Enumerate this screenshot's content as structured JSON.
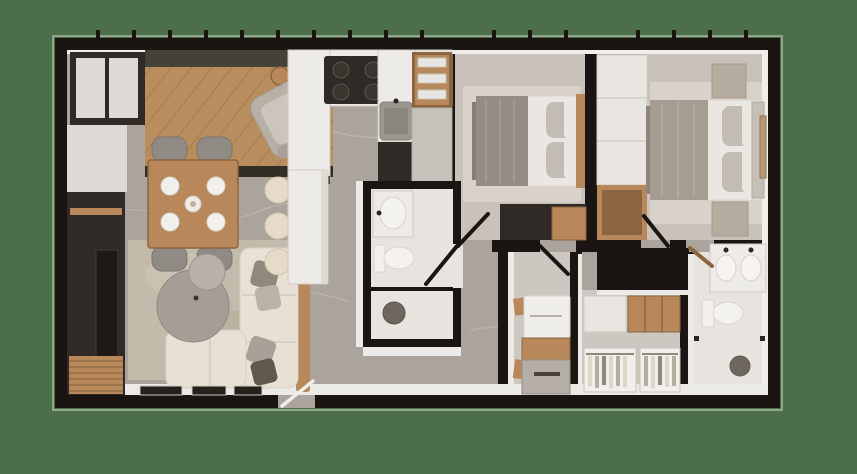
{
  "scene": {
    "type": "3d-floor-plan-render",
    "view": "top-down",
    "unit": "two-bedroom two-bathroom apartment",
    "rooms": [
      {
        "name": "entry-foyer",
        "furniture": [
          "wardrobe",
          "diagonal-wood-floor",
          "armchair",
          "ottoman",
          "side-table"
        ]
      },
      {
        "name": "dining-area",
        "furniture": [
          "wall-shelving",
          "dining-table",
          "chair",
          "chair",
          "chair",
          "chair",
          "plates",
          "centerpiece"
        ]
      },
      {
        "name": "living-room",
        "furniture": [
          "media-wall",
          "tv",
          "slat-bench",
          "rug",
          "l-sofa",
          "pillows",
          "round-ottoman",
          "picture-ledge"
        ]
      },
      {
        "name": "kitchen",
        "furniture": [
          "counter",
          "cooktop",
          "sink",
          "dish-shelf",
          "tall-cabinet",
          "island",
          "bar-stools"
        ]
      },
      {
        "name": "bathroom-main",
        "furniture": [
          "vanity-sink",
          "toilet",
          "shower",
          "floor-drain",
          "glass-screen"
        ]
      },
      {
        "name": "bedroom-secondary",
        "furniture": [
          "double-bed",
          "pillows",
          "headboard",
          "rug",
          "dresser"
        ]
      },
      {
        "name": "bedroom-master",
        "furniture": [
          "double-bed",
          "pillows",
          "headboard",
          "nightstand",
          "nightstand",
          "wardrobe-column",
          "wood-niche",
          "wall-art",
          "rug"
        ]
      },
      {
        "name": "laundry-nook",
        "furniture": [
          "washer",
          "wood-cabinet",
          "utility-sink",
          "wall-hooks"
        ]
      },
      {
        "name": "walk-in-closet",
        "furniture": [
          "upper-cabinets",
          "hanging-clothes-rack",
          "hanging-clothes-rack"
        ]
      },
      {
        "name": "bathroom-master",
        "furniture": [
          "double-vanity",
          "toilet",
          "shower",
          "floor-drain"
        ]
      }
    ],
    "doors": [
      "entry-door",
      "bathroom-main-door",
      "bedroom-secondary-door",
      "closet-door",
      "bedroom-master-door",
      "bathroom-master-door"
    ],
    "windows": "mullion-ticks-along-top-wall"
  },
  "palette": {
    "bg": "#4c6f49",
    "wall": "#1a1512",
    "floor": "#aba49d",
    "vein": "#c6c0b9",
    "floorBed": "#c9c2ba",
    "rugBed": "#d8d2ca",
    "floorBath": "#e7e3de",
    "floorUtil": "#ccc7c0",
    "white": "#eceae7",
    "whiteWall": "#f0eee9",
    "cream": "#ddd9d4",
    "marble": "#edebe7",
    "sofa": "#e7e0d3",
    "rugLiv": "#c3baab",
    "dark": "#2f2a26",
    "darkBand": "#44403a",
    "gray": "#8f8a84",
    "grayLight": "#c2bcb4",
    "blanketA": "#938d85",
    "blanketB": "#a59d92",
    "sheet": "#eae7e2",
    "steel": "#9b968f",
    "stone": "#b5ab9e",
    "stool": "#e5dbc8",
    "drain": "#6e675f",
    "screen": "#1c1916",
    "wood": "#b9885a",
    "woodDark": "#8a6540",
    "woodFloor": "#b98e5e",
    "frame": "#26211d",
    "clothesA": "#ddd6c9",
    "clothesB": "#b5ae9f",
    "clothesC": "#8f887c"
  }
}
